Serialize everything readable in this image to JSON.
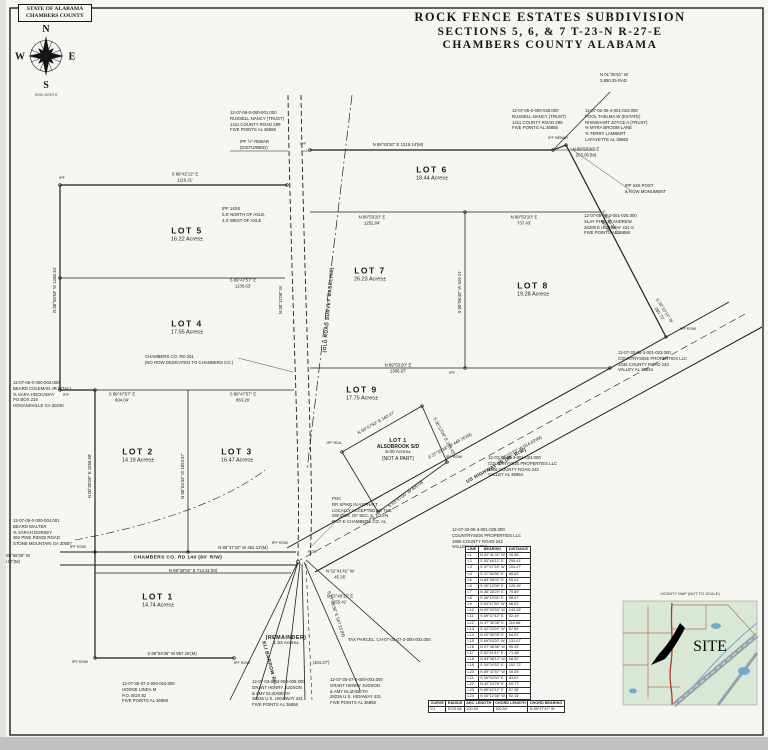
{
  "stamp": {
    "line1": "STATE OF ALABAMA",
    "line2": "CHAMBERS COUNTY"
  },
  "compass": {
    "n": "N",
    "e": "E",
    "s": "S",
    "w": "W",
    "caption": "GRID NORTH"
  },
  "title": {
    "line1": "ROCK FENCE ESTATES SUBDIVISION",
    "line2": "SECTIONS 5, 6, & 7 T-23-N R-27-E",
    "line3": "CHAMBERS COUNTY    ALABAMA"
  },
  "lots": [
    {
      "n": "LOT 5",
      "a": "16.22 Acres±",
      "x": 187,
      "y": 235
    },
    {
      "n": "LOT 4",
      "a": "17.55 Acres±",
      "x": 187,
      "y": 328
    },
    {
      "n": "LOT 2",
      "a": "14.19 Acres±",
      "x": 138,
      "y": 456
    },
    {
      "n": "LOT 3",
      "a": "16.47 Acres±",
      "x": 237,
      "y": 456
    },
    {
      "n": "LOT 1",
      "a": "14.74 Acres±",
      "x": 158,
      "y": 601
    },
    {
      "n": "LOT 6",
      "a": "18.44 Acres±",
      "x": 432,
      "y": 174
    },
    {
      "n": "LOT 7",
      "a": "26.23 Acres±",
      "x": 370,
      "y": 275
    },
    {
      "n": "LOT 8",
      "a": "19.28 Acres±",
      "x": 533,
      "y": 290
    },
    {
      "n": "LOT 9",
      "a": "17.75 Acres±",
      "x": 362,
      "y": 394
    },
    {
      "n": "LOT 1",
      "s": "ALSOBROOK S/D",
      "a": "5.00 Acres±",
      "note": "(NOT A PART)",
      "x": 398,
      "y": 450,
      "small": true
    },
    {
      "n": "(REMAINDER)",
      "a": "1.63 Acres±",
      "x": 286,
      "y": 641,
      "small": true
    }
  ],
  "bearings": [
    {
      "t1": "S 89°42'12\" E",
      "t2": "1119.21'",
      "x": 185,
      "y": 177,
      "r": 0
    },
    {
      "t1": "S 89°47'57\" E",
      "t2": "1136.63'",
      "x": 243,
      "y": 283,
      "r": 0
    },
    {
      "t1": "S 89°47'57\" E",
      "t2": "863.29'",
      "x": 243,
      "y": 397,
      "r": 0
    },
    {
      "t1": "S 89°47'57\" E",
      "t2": "604.04'",
      "x": 122,
      "y": 397,
      "r": 0
    },
    {
      "t1": "N 89°53'20\" E  1319.14'(M)",
      "t2": "",
      "x": 398,
      "y": 145,
      "r": 0
    },
    {
      "t1": "N 89°53'20\" E",
      "t2": "253.06'(M)",
      "x": 586,
      "y": 152,
      "r": 0
    },
    {
      "t1": "N 89°53'20\" E",
      "t2": "1252.84'",
      "x": 372,
      "y": 220,
      "r": 0
    },
    {
      "t1": "N 89°53'20\" E",
      "t2": "737.43'",
      "x": 524,
      "y": 220,
      "r": 0
    },
    {
      "t1": "N 89°53'20\" E",
      "t2": "1386.97'",
      "x": 398,
      "y": 368,
      "r": 0
    },
    {
      "t1": "N 89°28'02\" E  714.31'(M)",
      "t2": "",
      "x": 193,
      "y": 571,
      "r": 0
    },
    {
      "t1": "N 89°47'42\" W  452.12'(M)",
      "t2": "",
      "x": 243,
      "y": 548,
      "r": 0
    },
    {
      "t1": "S 89°53'35\" W  957.26'(M)",
      "t2": "",
      "x": 172,
      "y": 654,
      "r": 0
    },
    {
      "t1": "N 52°41'41\" W",
      "t2": "45.36'",
      "x": 340,
      "y": 574,
      "r": 0
    },
    {
      "t1": "S 53°48'12\" E",
      "t2": "255.41'",
      "x": 340,
      "y": 599,
      "r": 0
    },
    {
      "t1": "(104.27')",
      "t2": "",
      "x": 321,
      "y": 663,
      "r": 0
    },
    {
      "t1": "S 37°27'23\" W  914.83'(M)",
      "t2": "",
      "x": 520,
      "y": 449,
      "r": -29
    },
    {
      "t1": "S 37°35'38\" W  448.76'(M)",
      "t2": "",
      "x": 450,
      "y": 446,
      "r": -29
    },
    {
      "t1": "S 07°46'36\" E  547.21'(M)",
      "t2": "",
      "x": 336,
      "y": 614,
      "r": 72
    },
    {
      "t1": "S 32°23'29\" W",
      "t2": "465.08'",
      "x": 608,
      "y": 224,
      "r": 57
    },
    {
      "t1": "S 30°10'14\" W",
      "t2": "260.70'",
      "x": 662,
      "y": 312,
      "r": 57
    },
    {
      "t1": "N 00°03'53\" W  1288.34'",
      "t2": "",
      "x": 55,
      "y": 290,
      "r": -90
    },
    {
      "t1": "N 00°05'09\" E  1058.98'",
      "t2": "",
      "x": 90,
      "y": 476,
      "r": -90
    },
    {
      "t1": "N 00°04'33\" W  1093.57'",
      "t2": "",
      "x": 183,
      "y": 476,
      "r": -90
    },
    {
      "t1": "S 00°06'40\" W  529.21'",
      "t2": "",
      "x": 460,
      "y": 292,
      "r": -90
    },
    {
      "t1": "N 00°12'08\" W",
      "t2": "",
      "x": 281,
      "y": 300,
      "r": -90
    },
    {
      "t1": "N 59°47'50\" E  160.47'",
      "t2": "",
      "x": 376,
      "y": 423,
      "r": -30
    },
    {
      "t1": "S 36°12'04\" E  263.43'",
      "t2": "",
      "x": 444,
      "y": 436,
      "r": 62
    },
    {
      "t1": "S 53°47'50\" W  400.06'",
      "t2": "",
      "x": 406,
      "y": 494,
      "r": -36
    }
  ],
  "owner_notes": [
    {
      "x": 230,
      "y": 110,
      "lines": [
        "12-07-06-0-000-001.000",
        "RUSSELL NANCY (TRUST)",
        "1411 COUNTY ROAD 299",
        "FIVE POINTS AL  36855"
      ]
    },
    {
      "x": 512,
      "y": 108,
      "lines": [
        "12-07-05-0-000-028.000",
        "RUSSELL NANCY (TRUST)",
        "1411 COUNTY ROAD 299",
        "FIVE POINTS AL  36855"
      ]
    },
    {
      "x": 585,
      "y": 108,
      "lines": [
        "12-07-02-06-4-001-023.000",
        "POOL THELMA W (ESTATE)",
        "RHINEHART JOYCE A (TRUST)",
        "% MYRA BROOM LANE",
        "% TERRY LAMBERT",
        "LAFAYETTE AL  36862"
      ]
    },
    {
      "x": 584,
      "y": 213,
      "lines": [
        "12-07-05-06-3-001-025.000",
        "SLAY PHILLIP ANDREW",
        "28209 E HIGHWAY 431-S",
        "FIVE POINTS AL  36858"
      ]
    },
    {
      "x": 618,
      "y": 350,
      "lines": [
        "12-07-33-06-3-001-023.000",
        "COUNTRYSIDE PROPERTIES LLC",
        "1345 COUNTY ROAD 243",
        "VALLEY AL  36854"
      ]
    },
    {
      "x": 488,
      "y": 455,
      "lines": [
        "12-07-33-06-3-001-024.000",
        "COUNTRYSIDE PROPERTIES LLC",
        "1906 COUNTY ROAD 242",
        "VALLEY AL  36854"
      ]
    },
    {
      "x": 452,
      "y": 527,
      "lines": [
        "12-07-33-06-3-001-025.000",
        "COUNTRYSIDE PROPERTIES LLC",
        "1906 COUNTY ROAD 242",
        "VALLEY AL  36854"
      ]
    },
    {
      "x": 13,
      "y": 380,
      "lines": [
        "12-07-06-0-000-002.000",
        "BEARD COLEMAN JR (ETAL)",
        "% SARA HOCKADAY",
        "PO BOX 216",
        "HOGANSVILLE GA  30230"
      ]
    },
    {
      "x": 13,
      "y": 518,
      "lines": [
        "12-07-06-0-000-004.001",
        "BEARD WALTER",
        "% SARAH DORSEY",
        "362 PINE RIDGE ROAD",
        "STONE MOUNTAIN GA  30087"
      ]
    },
    {
      "x": 122,
      "y": 681,
      "lines": [
        "12-07-35-07-2-000-010.000",
        "HODGE LINDA M",
        "P.O. BOX 82",
        "FIVE POINTS AL  36858"
      ]
    },
    {
      "x": 252,
      "y": 679,
      "lines": [
        "12-07-03-07-3-000-009.000",
        "GRANT HENRY JUDSON",
        "& AMY ELIZABETH",
        "28226 U.S. HIGHWAY 431",
        "FIVE POINTS AL  36858"
      ]
    },
    {
      "x": 330,
      "y": 677,
      "lines": [
        "12-07-35-07-0-000-003.000",
        "GRANT HENRY JUDSON",
        "& AMY ELIZABETH",
        "28226 U.S. HIGHWAY 431",
        "FIVE POINTS AL  36858"
      ]
    },
    {
      "x": 332,
      "y": 496,
      "lines": [
        "POC",
        "RR SPIKE IN ASPHALT",
        "LOCALLY ACCEPTED AS THE",
        "SW COR. OF SEC. 5, T-23-N",
        "R-27-E CHAMBERS CO. AL"
      ]
    },
    {
      "x": 145,
      "y": 354,
      "lines": [
        "CHAMBERS CO. RD 251",
        "(NO ROW DEDICATED TO CHAMBERS CO.)"
      ]
    },
    {
      "x": 240,
      "y": 139,
      "lines": [
        "IPF ½\" REBAR",
        "(DISTURBED)"
      ]
    },
    {
      "x": 222,
      "y": 206,
      "lines": [
        "IPF 14X8",
        "0.8' NORTH OF AXLE,",
        "4.3' WEST OF AXLE"
      ]
    },
    {
      "x": 600,
      "y": 72,
      "lines": [
        "N 01°25'51\" W",
        "2,850.25 RAD"
      ]
    },
    {
      "x": 2,
      "y": 553,
      "lines": [
        "N 89°58'29\" W",
        "60.07'(M)"
      ]
    },
    {
      "x": 348,
      "y": 637,
      "lines": [
        "TAX PARCEL: CH-07-02-07-3-000-002.000"
      ]
    },
    {
      "x": 625,
      "y": 183,
      "lines": [
        "IPF 6X6 POST",
        "& ROW MONUMENT"
      ]
    }
  ],
  "markers": [
    {
      "t": "IPF ROW",
      "x": 78,
      "y": 548
    },
    {
      "t": "IPF ROW",
      "x": 280,
      "y": 544
    },
    {
      "t": "IPF ROW",
      "x": 80,
      "y": 663
    },
    {
      "t": "IPF ROW",
      "x": 242,
      "y": 664
    },
    {
      "t": "IPF",
      "x": 303,
      "y": 145
    },
    {
      "t": "IPF REBAR",
      "x": 558,
      "y": 139
    },
    {
      "t": "IPF ROW",
      "x": 688,
      "y": 330
    },
    {
      "t": "IPF",
      "x": 452,
      "y": 374
    },
    {
      "t": "IPF RDA",
      "x": 334,
      "y": 444
    },
    {
      "t": "IPF ROW",
      "x": 454,
      "y": 458
    },
    {
      "t": "IPF",
      "x": 372,
      "y": 520
    },
    {
      "t": "IPF",
      "x": 62,
      "y": 179
    },
    {
      "t": "IPF",
      "x": 66,
      "y": 396
    },
    {
      "t": "POB",
      "x": 312,
      "y": 553
    }
  ],
  "roads": [
    {
      "t": "CHAMBERS CO. RD 140 (80' R/W)",
      "x": 178,
      "y": 559,
      "r": 0
    },
    {
      "t": "US HIGHWAY 29 (80' R/W)",
      "x": 497,
      "y": 467,
      "r": -29
    },
    {
      "t": "ELI BARROW RD.",
      "x": 268,
      "y": 664,
      "r": 75
    },
    {
      "t": "(OLD ROAD SURVEY BASELINE)",
      "x": 330,
      "y": 310,
      "r": -85
    }
  ],
  "line_table": {
    "headers": [
      "LINE",
      "BEARING",
      "DISTANCE"
    ],
    "rows": [
      [
        "L1",
        "N 52°41'41\" W",
        "45.36'"
      ],
      [
        "L2",
        "S 53°48'12\" E",
        "255.41'"
      ],
      [
        "L3",
        "S 37°27'23\" W",
        "104.27'"
      ],
      [
        "L4",
        "S 07°46'36\" E",
        "88.62'"
      ],
      [
        "L5",
        "N 89°28'02\" E",
        "60.24'"
      ],
      [
        "L6",
        "S 00°12'08\" E",
        "120.15'"
      ],
      [
        "L7",
        "N 36°28'20\" E",
        "75.80'"
      ],
      [
        "L8",
        "S 36°12'04\" E",
        "98.47'"
      ],
      [
        "L9",
        "S 53°47'50\" W",
        "66.02'"
      ],
      [
        "L10",
        "N 00°03'53\" W",
        "143.28'"
      ],
      [
        "L11",
        "S 89°47'42\" E",
        "52.19'"
      ],
      [
        "L12",
        "N 37°35'38\" E",
        "110.66'"
      ],
      [
        "L13",
        "S 32°23'29\" W",
        "87.54'"
      ],
      [
        "L14",
        "N 00°05'09\" E",
        "64.91'"
      ],
      [
        "L15",
        "S 89°53'20\" W",
        "131.07'"
      ],
      [
        "L16",
        "N 07°46'36\" W",
        "95.33'"
      ],
      [
        "L17",
        "S 52°41'41\" E",
        "71.48'"
      ],
      [
        "L18",
        "N 53°48'12\" W",
        "58.90'"
      ],
      [
        "L19",
        "S 00°04'33\" E",
        "102.72'"
      ],
      [
        "L20",
        "N 89°47'57\" W",
        "49.25'"
      ],
      [
        "L21",
        "S 36°00'00\" E",
        "83.61'"
      ],
      [
        "L22",
        "N 32°23'29\" E",
        "69.77'"
      ],
      [
        "L23",
        "S 89°42'12\" E",
        "57.38'"
      ],
      [
        "L24",
        "N 00°12'08\" W",
        "92.15'"
      ],
      [
        "L25",
        "S 37°27'23\" W",
        "78.03'"
      ],
      [
        "L26",
        "N 89°53'35\" E",
        "61.50'"
      ]
    ]
  },
  "curve_table": {
    "headers": [
      "CURVE",
      "RADIUS",
      "ARC LENGTH",
      "CHORD LENGTH",
      "CHORD BEARING"
    ],
    "rows": [
      [
        "C1",
        "5729.58'",
        "100.54'",
        "100.54'",
        "N 89°47'42\" W"
      ]
    ]
  },
  "vicinity": {
    "title": "VICINITY MAP  (NOT TO SCALE)",
    "site": "SITE"
  }
}
